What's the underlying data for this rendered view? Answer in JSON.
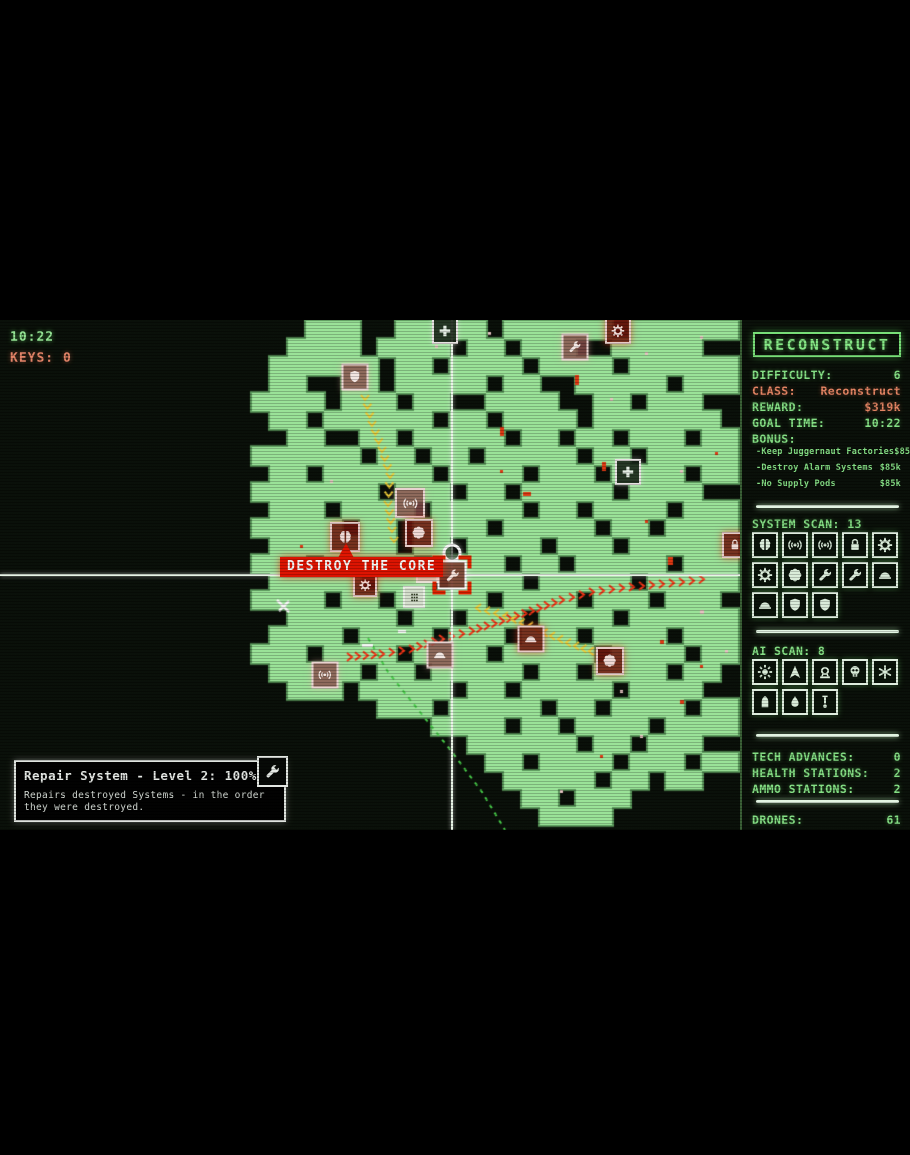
{
  "hud": {
    "timer": "10:22",
    "keys": "KEYS: 0"
  },
  "destroy_banner": {
    "label": "DESTROY THE CORE"
  },
  "tooltip": {
    "title": "Repair System - Level 2: 100% (1/2)",
    "body": "Repairs destroyed Systems - in the order they were destroyed.",
    "icon": "wrench"
  },
  "sidebar": {
    "title": "RECONSTRUCT",
    "stats": [
      {
        "label": "DIFFICULTY:",
        "value": "6",
        "lc": "c-g",
        "vc": "c-g"
      },
      {
        "label": "CLASS:",
        "value": "Reconstruct",
        "lc": "c-s",
        "vc": "c-s"
      },
      {
        "label": "REWARD:",
        "value": "$319k",
        "lc": "c-g",
        "vc": "c-s"
      },
      {
        "label": "GOAL TIME:",
        "value": "10:22",
        "lc": "c-g",
        "vc": "c-g"
      }
    ],
    "bonus": {
      "label": "BONUS:",
      "items": [
        {
          "label": "-Keep Juggernaut Factories",
          "value": "$85k"
        },
        {
          "label": "-Destroy Alarm Systems",
          "value": "$85k"
        },
        {
          "label": "-No Supply Pods",
          "value": "$85k"
        }
      ]
    },
    "system_scan": {
      "label": "SYSTEM SCAN: 13",
      "icons": [
        "brain",
        "signal",
        "signal",
        "lock",
        "gear",
        "gear",
        "flower",
        "wrench",
        "wrench",
        "helmet",
        "helmet",
        "shield",
        "shield"
      ]
    },
    "ai_scan": {
      "label": "AI SCAN: 8",
      "icons": [
        "sun",
        "arrow",
        "turret",
        "skull",
        "asterisk",
        "pod",
        "drop",
        "pendulum"
      ]
    },
    "stations": [
      {
        "label": "TECH ADVANCES:",
        "value": "0"
      },
      {
        "label": "HEALTH STATIONS:",
        "value": "2"
      },
      {
        "label": "AMMO STATIONS:",
        "value": "2"
      }
    ],
    "drones": {
      "label": "DRONES:",
      "value": "61"
    }
  },
  "map": {
    "cell": 18,
    "colors": {
      "fill": "#a2eba0",
      "halo": "#5d9c5e",
      "dash": "#49d14b",
      "trail_yellow": "#f5d23a",
      "trail_red": "#ff3517"
    },
    "rows": [
      "00000000000000000111001111101111110111111",
      "00000000000000001111011110110111001111100",
      "00000000000000011111101101111011110111111",
      "00000000000000011001101111101100111110111",
      "00000000000000111101110110011110011011100",
      "00000000000000011011111101101111011111110",
      "00000000000000001100110111110110110111011",
      "00000000000000111111011011011111011011111",
      "00000000000000011011111101111011101111011",
      "00000000000000111111101110110111110111100",
      "00000000000000011101111011111011011110111",
      "00000000000000111110110111101111101101111",
      "00000000000000011111110110111101110111111",
      "00000000000000111011111011110110111110111",
      "00000000000000011111011101111011111011111",
      "00000000000000111101101111101111011101110",
      "00000000000000001111110110111011110111111",
      "00000000000000011110111101110111011110111",
      "00000000000000111011110111101111101111011",
      "00000000000000011111011011111011011110110",
      "00000000000000001110111110110111110111100",
      "00000000000000000000011101111101101111011",
      "00000000000000000000000011110110111101111",
      "00000000000000000000000000111111011011100",
      "00000000000000000000000000011011110111011",
      "00000000000000000000000000001111101101100",
      "00000000000000000000000000000110111000000",
      "00000000000000000000000000000011110000000"
    ],
    "crosshair": {
      "x": 452,
      "y": 575
    },
    "marker": {
      "x": 452,
      "y": 553
    },
    "icons": [
      {
        "x": 445,
        "y": 331,
        "type": "plus",
        "variant": "plain",
        "size": 26
      },
      {
        "x": 618,
        "y": 331,
        "type": "gear",
        "variant": "red",
        "size": 26
      },
      {
        "x": 575,
        "y": 347,
        "type": "wrench",
        "variant": "pink",
        "size": 27
      },
      {
        "x": 355,
        "y": 377,
        "type": "shield",
        "variant": "pink",
        "size": 27
      },
      {
        "x": 628,
        "y": 472,
        "type": "plus",
        "variant": "plain",
        "size": 26
      },
      {
        "x": 410,
        "y": 503,
        "type": "signal",
        "variant": "pink",
        "size": 30
      },
      {
        "x": 419,
        "y": 533,
        "type": "flower",
        "variant": "red",
        "size": 28
      },
      {
        "x": 345,
        "y": 537,
        "type": "brain",
        "variant": "red",
        "size": 30
      },
      {
        "x": 735,
        "y": 545,
        "type": "lock",
        "variant": "red",
        "size": 26
      },
      {
        "x": 427,
        "y": 572,
        "type": "grid",
        "variant": "building",
        "size": 22
      },
      {
        "x": 414,
        "y": 597,
        "type": "grid",
        "variant": "building",
        "size": 22
      },
      {
        "x": 365,
        "y": 585,
        "type": "gear",
        "variant": "red",
        "size": 24
      },
      {
        "x": 531,
        "y": 639,
        "type": "helmet",
        "variant": "red",
        "size": 27
      },
      {
        "x": 440,
        "y": 655,
        "type": "helmet",
        "variant": "pink",
        "size": 27
      },
      {
        "x": 610,
        "y": 661,
        "type": "flower",
        "variant": "red",
        "size": 28
      },
      {
        "x": 325,
        "y": 675,
        "type": "signal",
        "variant": "pink",
        "size": 27
      },
      {
        "x": 452,
        "y": 575,
        "type": "wrench",
        "variant": "selected",
        "size": 29
      }
    ],
    "trails": [
      {
        "color": "#f5d23a",
        "dir": "down",
        "points": [
          [
            365,
            398
          ],
          [
            372,
            424
          ],
          [
            382,
            450
          ],
          [
            390,
            476
          ],
          [
            388,
            504
          ],
          [
            392,
            530
          ],
          [
            396,
            550
          ]
        ]
      },
      {
        "color": "#ff3517",
        "dir": "right",
        "points": [
          [
            350,
            657
          ],
          [
            382,
            654
          ],
          [
            412,
            649
          ],
          [
            442,
            639
          ],
          [
            472,
            631
          ],
          [
            502,
            621
          ],
          [
            532,
            611
          ],
          [
            562,
            600
          ],
          [
            592,
            592
          ],
          [
            622,
            588
          ],
          [
            652,
            585
          ],
          [
            682,
            582
          ],
          [
            712,
            578
          ]
        ]
      },
      {
        "color": "#f5d23a",
        "dir": "left",
        "points": [
          [
            478,
            608
          ],
          [
            505,
            616
          ],
          [
            530,
            626
          ],
          [
            552,
            636
          ],
          [
            576,
            646
          ],
          [
            598,
            654
          ]
        ]
      }
    ],
    "dashed_line": [
      [
        368,
        638
      ],
      [
        388,
        672
      ],
      [
        420,
        712
      ],
      [
        452,
        752
      ],
      [
        482,
        792
      ],
      [
        505,
        830
      ]
    ],
    "cross_marker": {
      "x": 283,
      "y": 606
    },
    "dots": [
      {
        "x": 575,
        "y": 375,
        "w": 4,
        "h": 10,
        "c": "#e63812"
      },
      {
        "x": 500,
        "y": 427,
        "w": 4,
        "h": 9,
        "c": "#e63812"
      },
      {
        "x": 602,
        "y": 462,
        "w": 4,
        "h": 9,
        "c": "#e63812"
      },
      {
        "x": 668,
        "y": 557,
        "w": 5,
        "h": 8,
        "c": "#e63812"
      },
      {
        "x": 523,
        "y": 492,
        "w": 8,
        "h": 4,
        "c": "#e63812"
      },
      {
        "x": 435,
        "y": 345,
        "w": 3,
        "h": 3,
        "c": "#efc9c9"
      },
      {
        "x": 488,
        "y": 332,
        "w": 3,
        "h": 3,
        "c": "#efc9c9"
      },
      {
        "x": 700,
        "y": 336,
        "w": 3,
        "h": 3,
        "c": "#efc9c9"
      },
      {
        "x": 645,
        "y": 352,
        "w": 3,
        "h": 3,
        "c": "#efc9c9"
      },
      {
        "x": 610,
        "y": 398,
        "w": 3,
        "h": 3,
        "c": "#efc9c9"
      },
      {
        "x": 680,
        "y": 470,
        "w": 3,
        "h": 3,
        "c": "#efc9c9"
      },
      {
        "x": 715,
        "y": 452,
        "w": 3,
        "h": 3,
        "c": "#e63812"
      },
      {
        "x": 645,
        "y": 520,
        "w": 3,
        "h": 3,
        "c": "#e63812"
      },
      {
        "x": 700,
        "y": 610,
        "w": 4,
        "h": 4,
        "c": "#efc9c9"
      },
      {
        "x": 725,
        "y": 650,
        "w": 3,
        "h": 3,
        "c": "#efc9c9"
      },
      {
        "x": 660,
        "y": 640,
        "w": 4,
        "h": 4,
        "c": "#e63812"
      },
      {
        "x": 700,
        "y": 665,
        "w": 3,
        "h": 3,
        "c": "#e63812"
      },
      {
        "x": 620,
        "y": 690,
        "w": 3,
        "h": 3,
        "c": "#efc9c9"
      },
      {
        "x": 680,
        "y": 700,
        "w": 4,
        "h": 4,
        "c": "#e63812"
      },
      {
        "x": 640,
        "y": 735,
        "w": 3,
        "h": 3,
        "c": "#efc9c9"
      },
      {
        "x": 600,
        "y": 755,
        "w": 3,
        "h": 3,
        "c": "#e63812"
      },
      {
        "x": 560,
        "y": 790,
        "w": 3,
        "h": 3,
        "c": "#efc9c9"
      },
      {
        "x": 500,
        "y": 470,
        "w": 3,
        "h": 3,
        "c": "#e63812"
      },
      {
        "x": 330,
        "y": 480,
        "w": 3,
        "h": 3,
        "c": "#efc9c9"
      },
      {
        "x": 300,
        "y": 545,
        "w": 3,
        "h": 3,
        "c": "#e63812"
      },
      {
        "x": 362,
        "y": 644,
        "w": 11,
        "h": 3,
        "c": "#ffffff"
      },
      {
        "x": 398,
        "y": 630,
        "w": 8,
        "h": 3,
        "c": "#ffffff"
      }
    ]
  }
}
